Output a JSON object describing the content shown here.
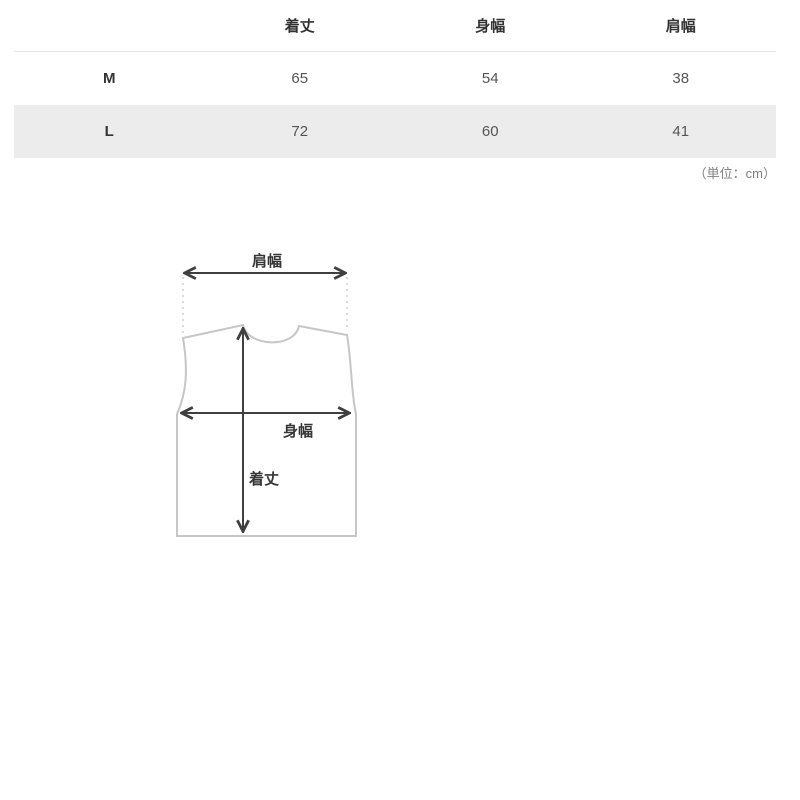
{
  "colors": {
    "background": "#ffffff",
    "row_alt_bg": "#ececec",
    "header_divider": "#e6e6e6",
    "header_text": "#333333",
    "value_text": "#555555",
    "unit_text": "#7f7f7f",
    "arrow": "#3f3f3f",
    "garment_outline": "#c6c6c6",
    "dashed_guide": "#c3c3c3"
  },
  "size_table": {
    "columns": [
      "着丈",
      "身幅",
      "肩幅"
    ],
    "rows": [
      {
        "size": "M",
        "values": [
          "65",
          "54",
          "38"
        ]
      },
      {
        "size": "L",
        "values": [
          "72",
          "60",
          "41"
        ]
      }
    ],
    "unit_note": "（単位：cm）"
  },
  "diagram": {
    "labels": {
      "shoulder_width": "肩幅",
      "body_width": "身幅",
      "length": "着丈"
    }
  }
}
